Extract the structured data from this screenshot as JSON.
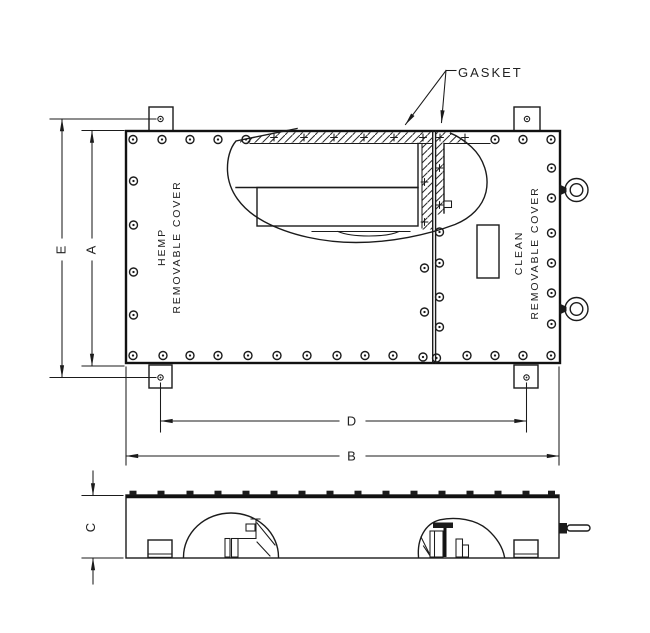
{
  "drawing": {
    "title_hint": "enclosure with removable covers - front and side orthographic views",
    "callouts": {
      "gasket": "GASKET"
    },
    "hemp_cover": {
      "line1": "HEMP",
      "line2": "REMOVABLE COVER"
    },
    "clean_cover": {
      "line1": "CLEAN",
      "line2": "REMOVABLE COVER"
    },
    "dimensions": {
      "overall_height": "E",
      "cover_height": "A",
      "mount_hole_spacing": "D",
      "overall_width": "B",
      "depth": "C"
    },
    "colors": {
      "ink": "#1b1b1b",
      "paper": "#ffffff"
    }
  }
}
